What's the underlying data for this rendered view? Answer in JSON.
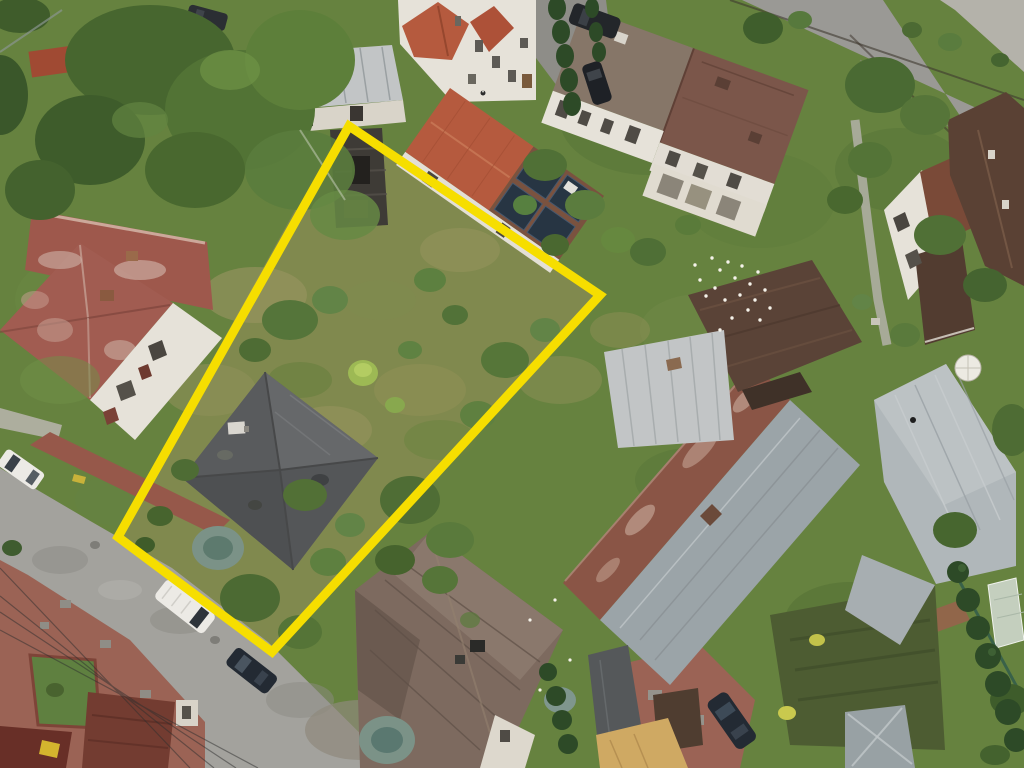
{
  "scene": {
    "type": "aerial-drone-photograph",
    "setting": "suburban residential block with detached houses, gardens, lawns and two streets",
    "lighting": "overcast daylight"
  },
  "annotation": {
    "label": "plot-boundary-outline",
    "points": "349,126 600,295 272,652 118,537",
    "color": "#f6de00",
    "stroke_width": 9
  },
  "palette": {
    "lawn_base": "#66823f",
    "meadow": "#80894e",
    "road": "#a3a29d",
    "road_secondary": "#9a9995",
    "roof_orange_tile": "#b55a3e",
    "roof_weathered_red": "#9e584c",
    "roof_brown": "#7b564a",
    "roof_gray_brown": "#867668",
    "roof_dark_brown": "#5a4337",
    "roof_gray_house": "#5b5d5e",
    "roof_metal_silver": "#c2c5c6",
    "roof_steel_blue": "#b0b7ba",
    "roof_rusty": "#8a5546",
    "solar_panel": "#273543",
    "brick_paving": "#9b6355",
    "white_walls": "#e6e2d9",
    "conifer_green": "#2d4a27",
    "spruce_blue": "#7b9287",
    "car_white": "#eceae5",
    "car_dark": "#232a33",
    "car_yellow": "#d4b52e",
    "bird_white": "#f5f2ea"
  },
  "visible_objects": [
    "yellow quadrilateral boundary drawn over an overgrown plot",
    "dark gray hip-roof house inside the outlined plot",
    "ruined dark shed at top of the plot",
    "house with orange tile roof and rooftop solar panels",
    "semi-detached white house with brown roof",
    "weathered red tile roof house on the left",
    "large rusty roof house with gray metal section",
    "big brown metal roof house at bottom center",
    "steel blue metal roof house at right",
    "white van and dark car parked on the lower street",
    "white car on the left street",
    "flock of white pigeons on lawn and barn roof",
    "trimmed conifer hedges, blue spruces, birch and fruit trees",
    "brick paved courtyards at bottom corners"
  ]
}
